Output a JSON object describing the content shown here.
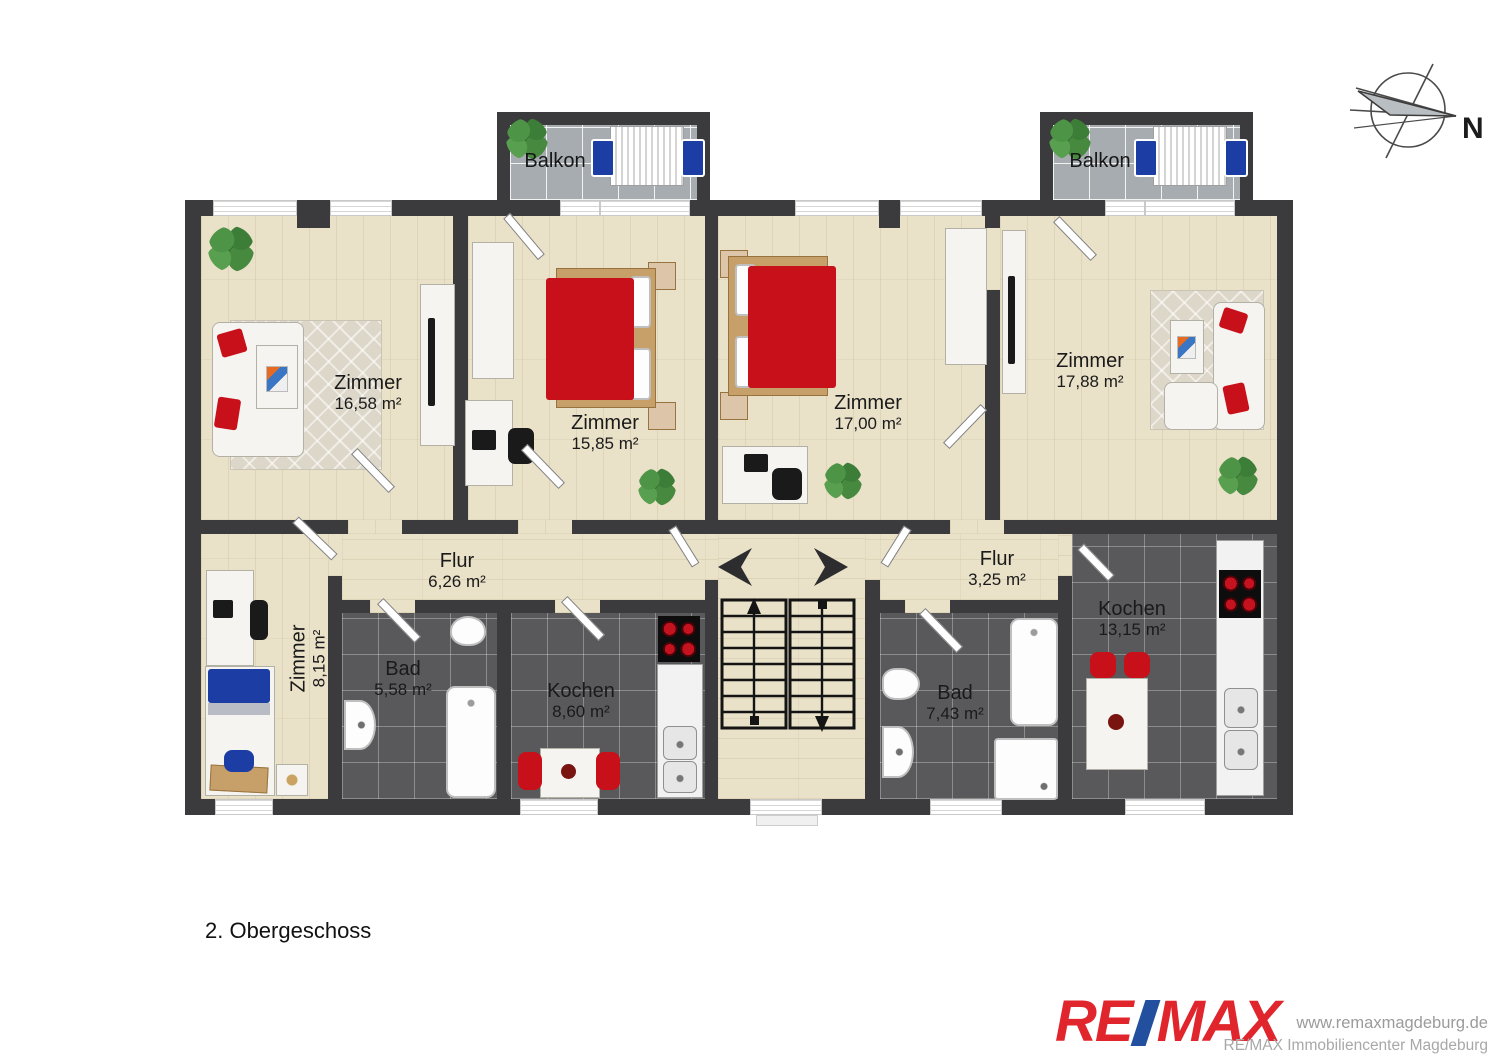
{
  "floor_label": "2. Obergeschoss",
  "compass": {
    "north_label": "N"
  },
  "balconies": {
    "left": {
      "label": "Balkon"
    },
    "right": {
      "label": "Balkon"
    }
  },
  "rooms": {
    "living1": {
      "name": "Zimmer",
      "area": "16,58 m²"
    },
    "bed1": {
      "name": "Zimmer",
      "area": "15,85 m²"
    },
    "bed2": {
      "name": "Zimmer",
      "area": "17,00 m²"
    },
    "living2": {
      "name": "Zimmer",
      "area": "17,88 m²"
    },
    "flur1": {
      "name": "Flur",
      "area": "6,26 m²"
    },
    "flur2": {
      "name": "Flur",
      "area": "3,25 m²"
    },
    "kids": {
      "name": "Zimmer",
      "area": "8,15 m²"
    },
    "bath1": {
      "name": "Bad",
      "area": "5,58 m²"
    },
    "kitchen1": {
      "name": "Kochen",
      "area": "8,60 m²"
    },
    "bath2": {
      "name": "Bad",
      "area": "7,43 m²"
    },
    "kitchen2": {
      "name": "Kochen",
      "area": "13,15 m²"
    }
  },
  "branding": {
    "logo_re": "RE",
    "logo_max": "MAX",
    "website": "www.remaxmagdeburg.de",
    "company": "RE/MAX Immobiliencenter Magdeburg",
    "remax_red": "#e0252c",
    "remax_blue": "#23509e"
  },
  "colors": {
    "wall": "#3b3b3d",
    "wood_floor": "#e9e1c8",
    "dark_tile": "#59595b",
    "balcony_tile": "#a7acb0",
    "furniture_red": "#c8101b",
    "furniture_blue": "#1c3ea4"
  }
}
